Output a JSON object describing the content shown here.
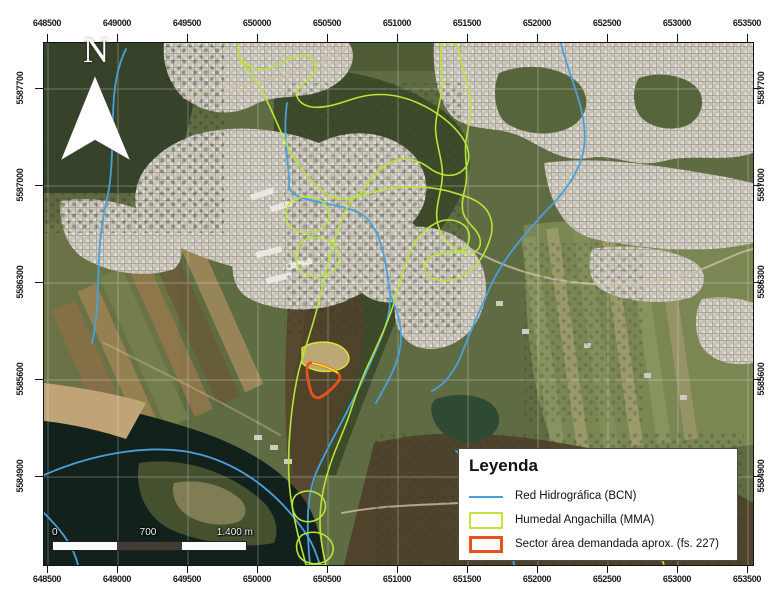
{
  "axes": {
    "x_labels": [
      "648500",
      "649000",
      "649500",
      "650000",
      "650500",
      "651000",
      "651500",
      "652000",
      "652500",
      "653000",
      "653500"
    ],
    "y_labels": [
      "5587700",
      "5587000",
      "5586300",
      "5585600",
      "5584900"
    ]
  },
  "north_arrow": {
    "label": "N"
  },
  "scale_bar": {
    "tick_start": "0",
    "tick_mid": "700",
    "tick_end": "1.400 m"
  },
  "legend": {
    "title": "Leyenda",
    "items": [
      {
        "label": "Red Hidrográfica (BCN)",
        "swatch": "line",
        "color": "#4aa0dc"
      },
      {
        "label": "Humedal Angachilla (MMA)",
        "swatch": "rect",
        "color": "#c3e53e"
      },
      {
        "label": "Sector área demandada aprox. (fs. 227)",
        "swatch": "rect",
        "color": "#e8511c"
      }
    ]
  },
  "colors": {
    "hydro_line": "#4aa0dc",
    "wetland_outline": "#b8e437",
    "sector_outline": "#e8511c",
    "sector_highlight_edge": "#f2e122",
    "water": "#13211d",
    "urban": "#c6c1b7",
    "frame": "#141414"
  }
}
